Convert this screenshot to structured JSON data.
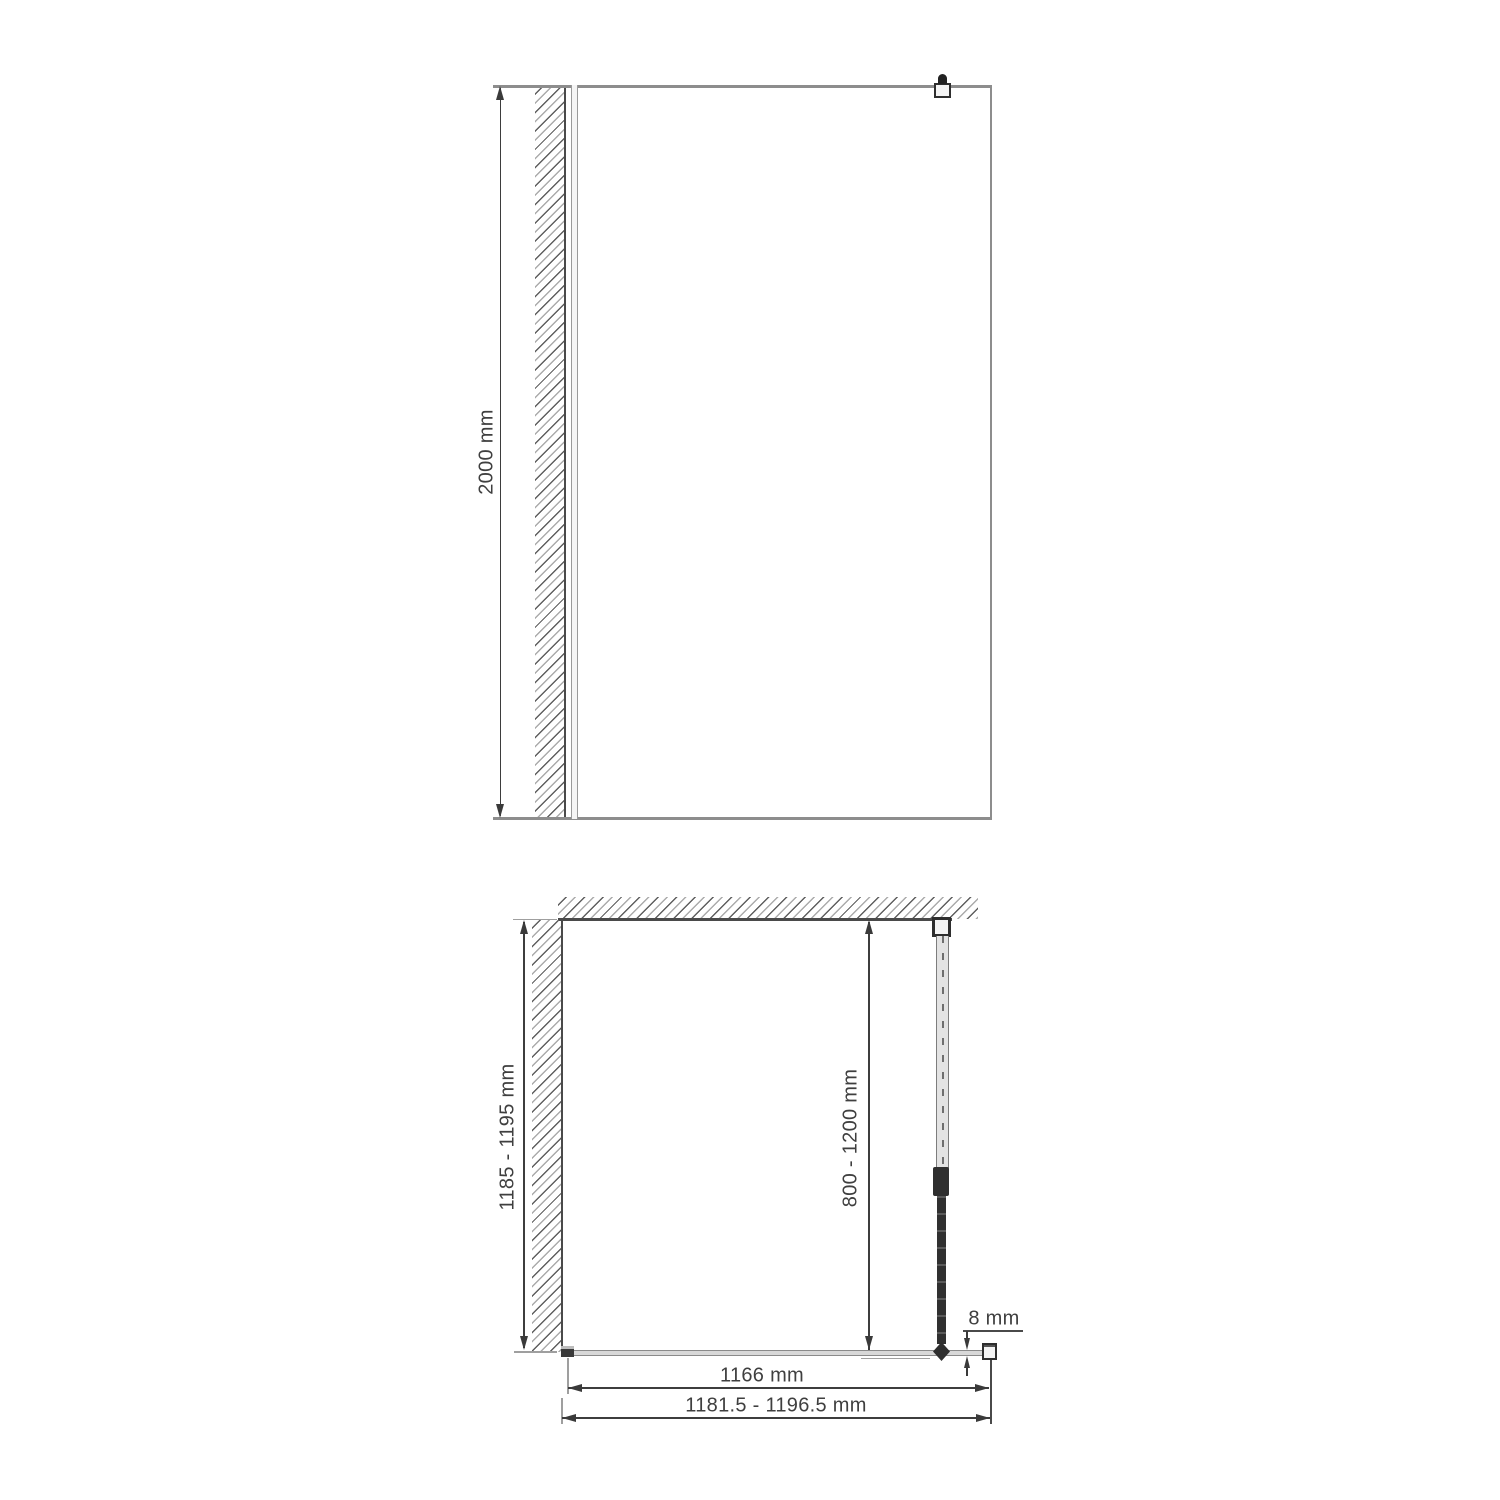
{
  "front_view": {
    "height_dimension": "2000 mm"
  },
  "plan_view": {
    "depth_dimension": "1185 - 1195 mm",
    "support_bar_dimension": "800 - 1200 mm",
    "glass_thickness_dimension": "8 mm",
    "glass_width_dimension": "1166 mm",
    "overall_width_dimension": "1181.5 - 1196.5 mm"
  },
  "colors": {
    "glass_line": "#8d8d8d",
    "wall_line": "#4a4a4a",
    "dimension": "#3d3d3d",
    "text": "#3f3f3f"
  }
}
